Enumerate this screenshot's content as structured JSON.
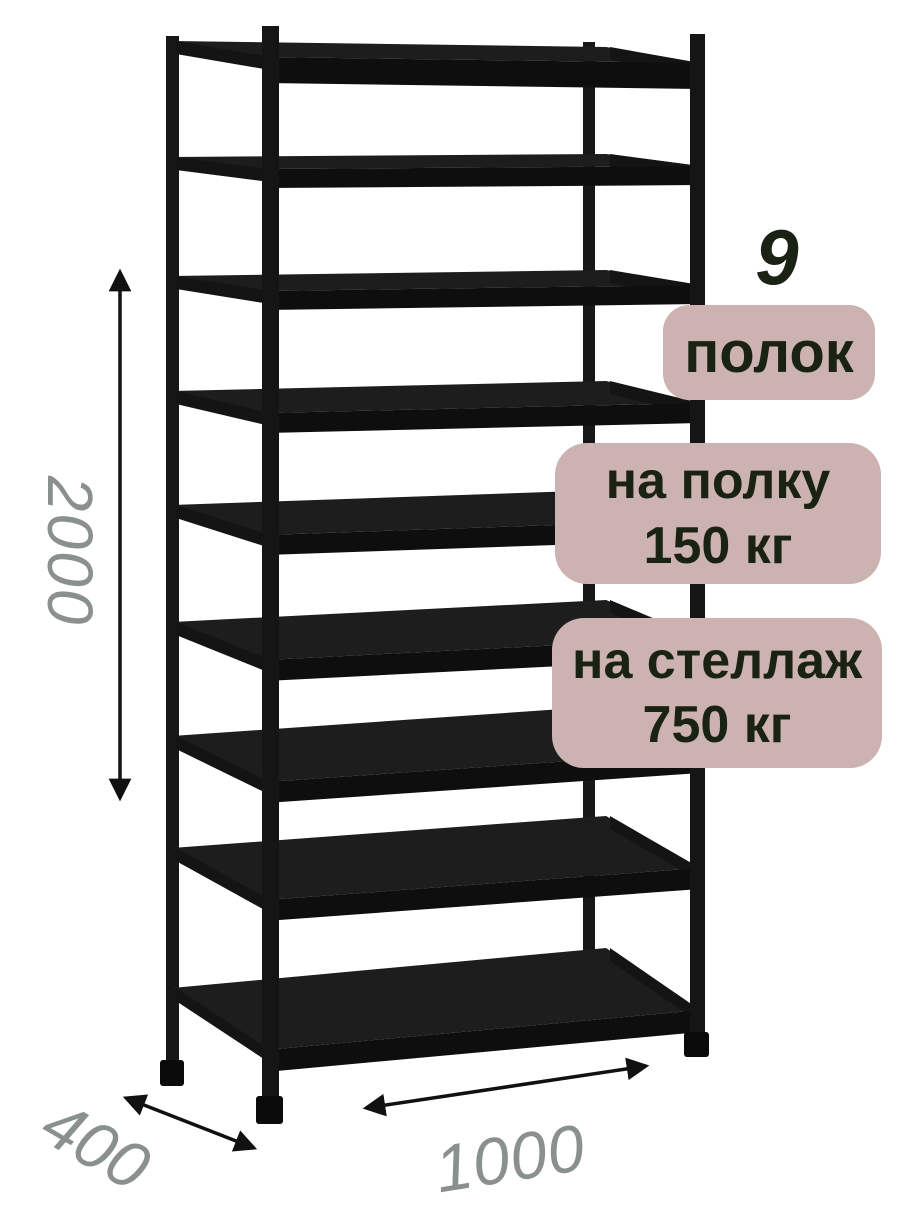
{
  "illustration": {
    "subject": "metal-shelving-rack",
    "shelf_count": 9,
    "rack_color": "#141414",
    "shelf_surface_color": "#1d1d1d",
    "shelf_bar_color": "#0e0e0e"
  },
  "dimensions": {
    "height_label": "2000",
    "depth_label": "400",
    "width_label": "1000",
    "label_color": "#8a918c",
    "arrow_color": "#111111"
  },
  "badges": {
    "bg_color": "#cdb2b2",
    "text_color": "#1a2213",
    "shelf_count_number": "9",
    "shelf_count_label": "полок",
    "per_shelf_line1": "на полку",
    "per_shelf_line2": "150 кг",
    "per_rack_line1": "на стеллаж",
    "per_rack_line2": "750 кг"
  }
}
